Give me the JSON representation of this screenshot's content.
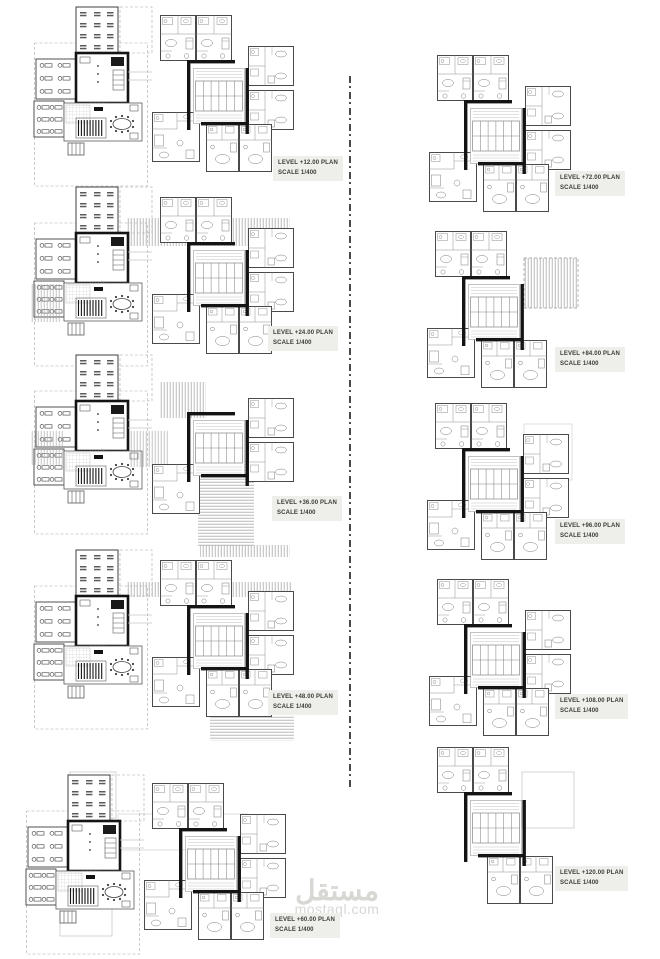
{
  "document": {
    "type": "architectural floor plan sheet",
    "watermark": {
      "arabic": "مستقل",
      "latin": "mostaql.com"
    }
  },
  "palette": {
    "wall": "#141414",
    "thin_line": "#8f8f8f",
    "hatch": "#a8a8a8",
    "label_bg": "#eeeeea",
    "label_text": "#3c3c3a",
    "watermark": "#d7d7d4"
  },
  "plans": {
    "left": [
      {
        "level": "LEVEL +12.00 PLAN",
        "scale": "SCALE 1/400"
      },
      {
        "level": "LEVEL +24.00 PLAN",
        "scale": "SCALE 1/400"
      },
      {
        "level": "LEVEL +36.00 PLAN",
        "scale": "SCALE 1/400"
      },
      {
        "level": "LEVEL +48.00 PLAN",
        "scale": "SCALE 1/400"
      },
      {
        "level": "LEVEL +60.00 PLAN",
        "scale": "SCALE 1/400"
      }
    ],
    "right": [
      {
        "level": "LEVEL +72.00 PLAN",
        "scale": "SCALE 1/400"
      },
      {
        "level": "LEVEL +84.00 PLAN",
        "scale": "SCALE 1/400"
      },
      {
        "level": "LEVEL +96.00 PLAN",
        "scale": "SCALE 1/400"
      },
      {
        "level": "LEVEL +108.00 PLAN",
        "scale": "SCALE 1/400"
      },
      {
        "level": "LEVEL +120.00 PLAN",
        "scale": "SCALE 1/400"
      }
    ]
  }
}
